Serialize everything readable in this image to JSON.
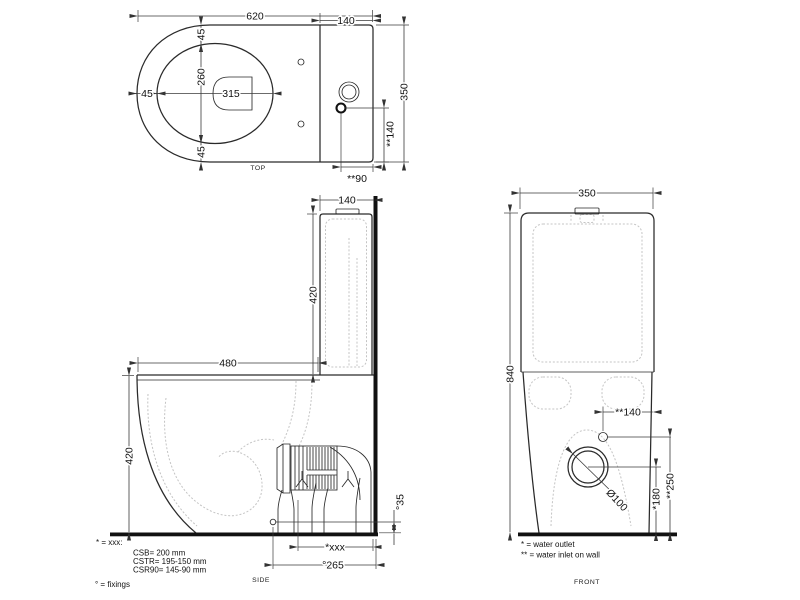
{
  "views": {
    "top": {
      "label": "TOP",
      "dims": {
        "total_width": "620",
        "tank_depth": "140",
        "total_depth": "350",
        "opening_length": "315",
        "opening_width": "260",
        "gap_left": "45",
        "gap_top": "45",
        "gap_bottom": "45",
        "inlet_from_side": "**140",
        "inlet_from_wall": "**90"
      }
    },
    "side": {
      "label": "SIDE",
      "dims": {
        "tank_depth": "140",
        "tank_height": "420",
        "bowl_depth": "480",
        "bowl_height": "420",
        "fixing_height": "°35",
        "outlet_distance": "*xxx",
        "fixing_distance": "°265"
      },
      "legend": [
        "* = xxx:",
        "CSB= 200 mm",
        "CSTR= 195-150 mm",
        "CSR90=  145-90 mm",
        "° = fixings"
      ]
    },
    "front": {
      "label": "FRONT",
      "dims": {
        "width": "350",
        "total_height": "840",
        "inlet_from_side": "**140",
        "outlet_diameter": "Ø100",
        "outlet_height": "*180",
        "inlet_height": "**250"
      },
      "legend": [
        "* = water outlet",
        "** = water inlet on wall"
      ]
    }
  },
  "colors": {
    "line": "#1a1a1a",
    "hidden": "#c4c4c4",
    "background": "#ffffff"
  }
}
